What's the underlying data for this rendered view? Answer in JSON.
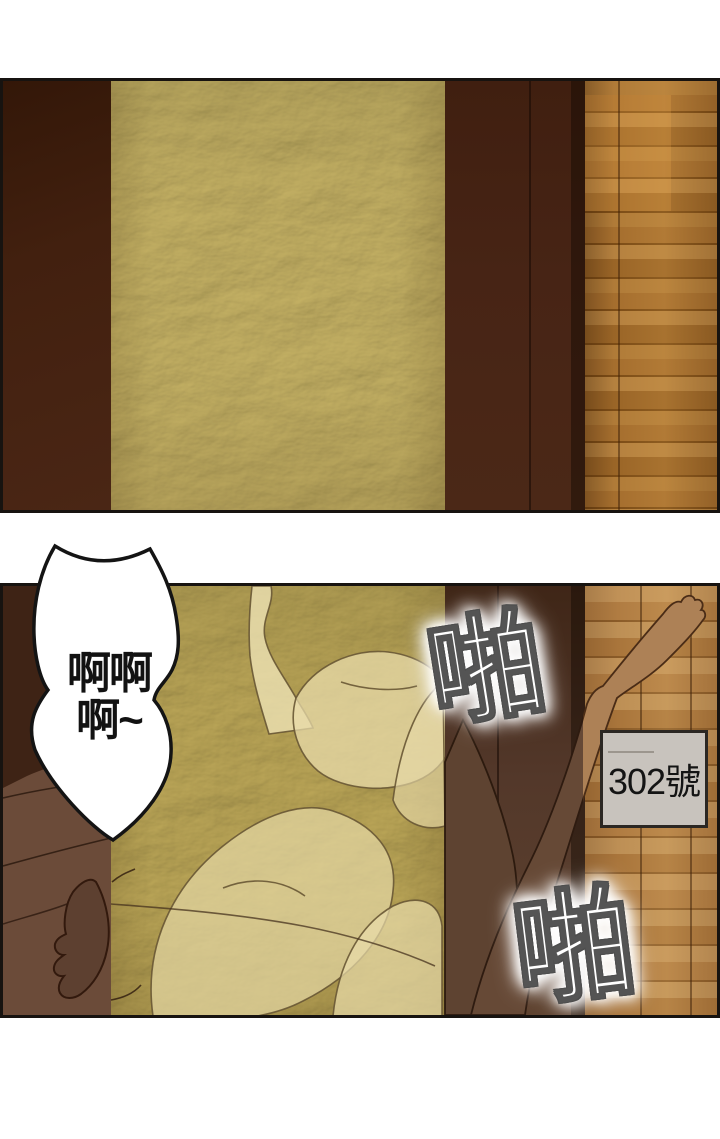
{
  "comic": {
    "panel1": {
      "sign": {
        "label": "302號"
      }
    },
    "panel2": {
      "sign": {
        "label": "302號"
      },
      "speech_bubble": {
        "line1": "啊啊",
        "line2": "啊~"
      },
      "sfx_top": "啪",
      "sfx_bottom": "啪"
    },
    "colors": {
      "page_background": "#ffffff",
      "panel_border": "#171310",
      "door_frame_dark": "#452213",
      "door_frame_light": "#53382a",
      "frosted_glass_gold": "#d4c78d",
      "hallway_wood": "#aa7433",
      "hallway_wood_light": "#b8894e",
      "sign_background": "#cbc7c1",
      "sign_border": "#2b2723",
      "speech_bubble_fill": "#ffffff",
      "speech_bubble_stroke": "#141414",
      "sfx_fill": "#ffffff",
      "sfx_outline": "#4e4e4e"
    }
  }
}
